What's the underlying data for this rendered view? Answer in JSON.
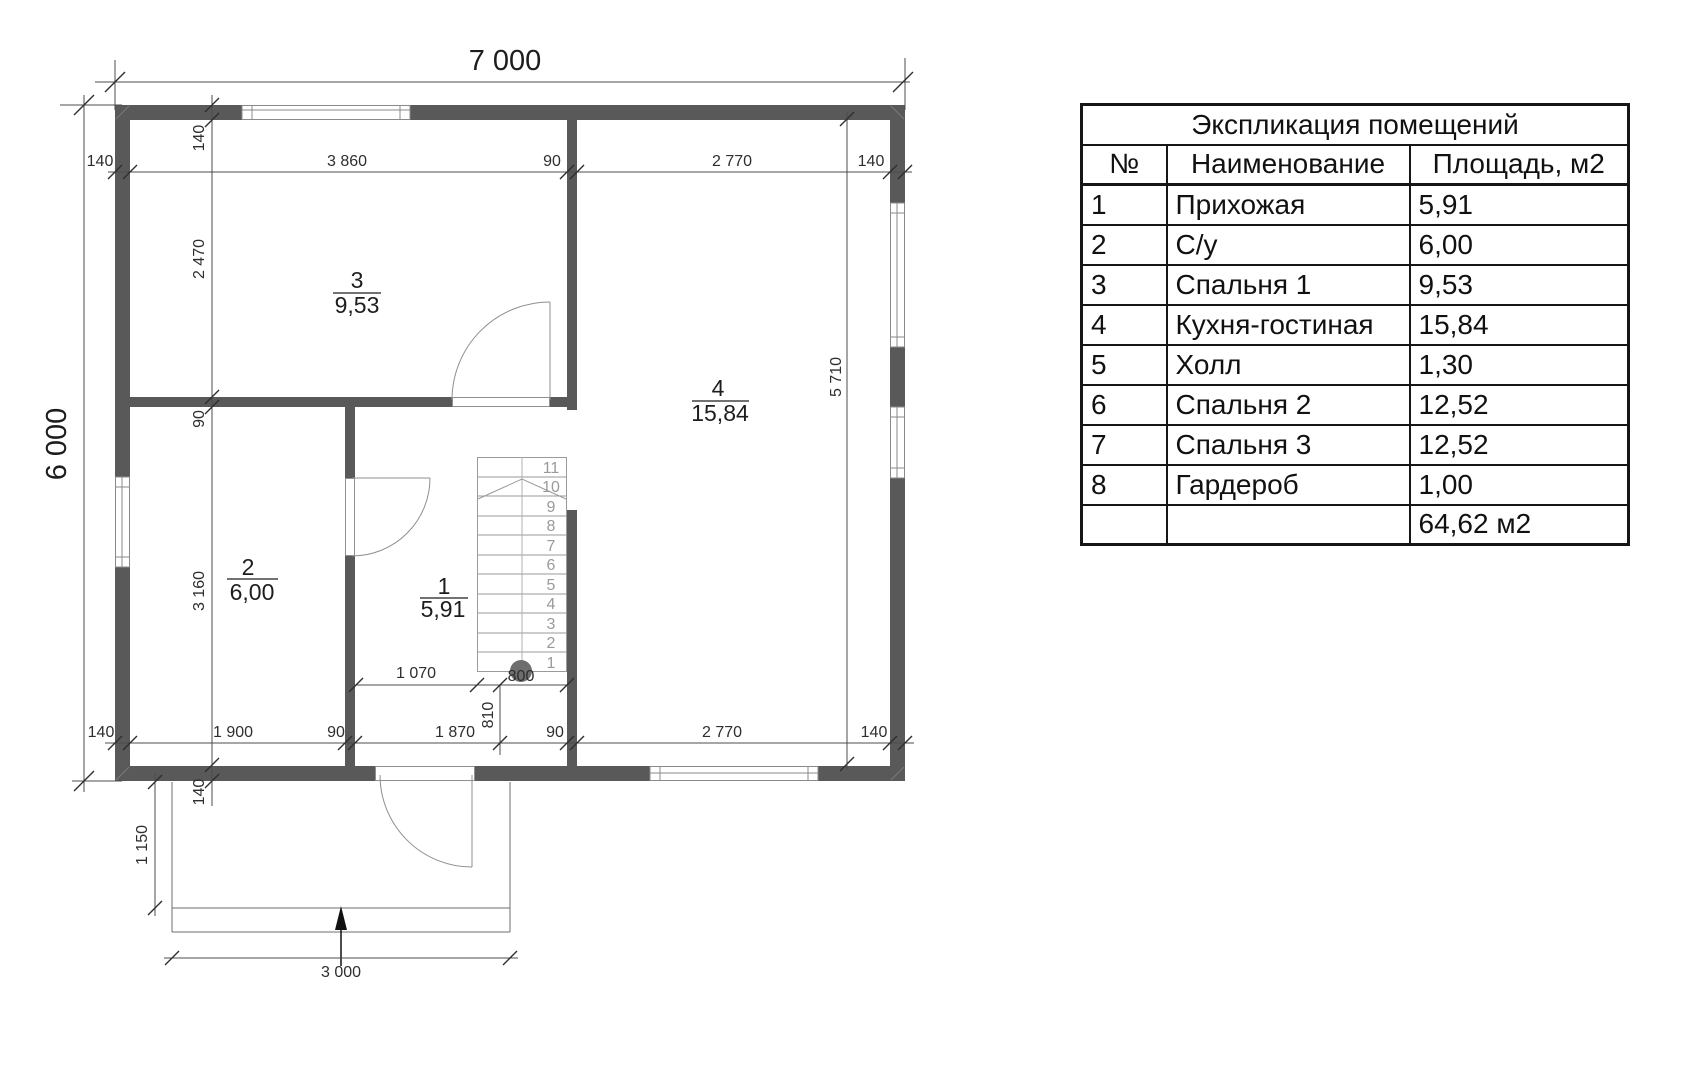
{
  "plan": {
    "overall": {
      "width": "7 000",
      "height": "6 000"
    },
    "dims": {
      "top": [
        "140",
        "3 860",
        "90",
        "2 770",
        "140"
      ],
      "left": [
        "140",
        "2 470",
        "90",
        "3 160",
        "140"
      ],
      "bottom": [
        "140",
        "1 900",
        "90",
        "1 870",
        "90",
        "2 770",
        "140"
      ],
      "right_inner": "5 710",
      "hall": [
        "1 070",
        "800",
        "810"
      ],
      "porch": [
        "1 150",
        "3 000"
      ]
    },
    "rooms": [
      {
        "number": "3",
        "area": "9,53"
      },
      {
        "number": "4",
        "area": "15,84"
      },
      {
        "number": "2",
        "area": "6,00"
      },
      {
        "number": "1",
        "area": "5,91"
      }
    ],
    "stairs": [
      "11",
      "10",
      "9",
      "8",
      "7",
      "6",
      "5",
      "4",
      "3",
      "2",
      "1"
    ]
  },
  "table": {
    "title": "Экспликация помещений",
    "headers": [
      "№",
      "Наименование",
      "Площадь, м2"
    ],
    "rows": [
      [
        "1",
        "Прихожая",
        "5,91"
      ],
      [
        "2",
        "С/у",
        "6,00"
      ],
      [
        "3",
        "Спальня 1",
        "9,53"
      ],
      [
        "4",
        "Кухня-гостиная",
        "15,84"
      ],
      [
        "5",
        "Холл",
        "1,30"
      ],
      [
        "6",
        "Спальня 2",
        "12,52"
      ],
      [
        "7",
        "Спальня 3",
        "12,52"
      ],
      [
        "8",
        "Гардероб",
        "1,00"
      ]
    ],
    "total": "64,62 м2"
  },
  "colors": {
    "wall": "#595959",
    "line": "#4c4c4c",
    "stair": "#9a9a9a",
    "circle": "#6e6e6e"
  }
}
